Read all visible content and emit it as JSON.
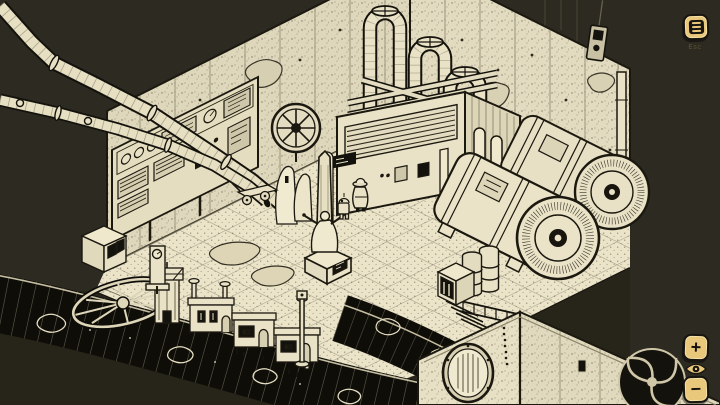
{
  "hud": {
    "menu_button": {
      "icon": "hamburger-menu-icon",
      "key_hint": "Esc"
    },
    "zoom": {
      "zoom_in_label": "+",
      "zoom_out_label": "−",
      "center_icon": "eye-icon"
    }
  },
  "scene": {
    "description": "Hand-inked isometric machine room with boiler, looping pipes, twin generators, obelisk statue, hooded character and miniature factory row over a black sewer pipe",
    "building_labels": [
      "02",
      "03"
    ],
    "colors": {
      "background": "#2c2a21",
      "paper": "#eae3c7",
      "wall": "#e2dbbf",
      "ink": "#1b1810",
      "button_gold": "#e9c87b"
    }
  }
}
